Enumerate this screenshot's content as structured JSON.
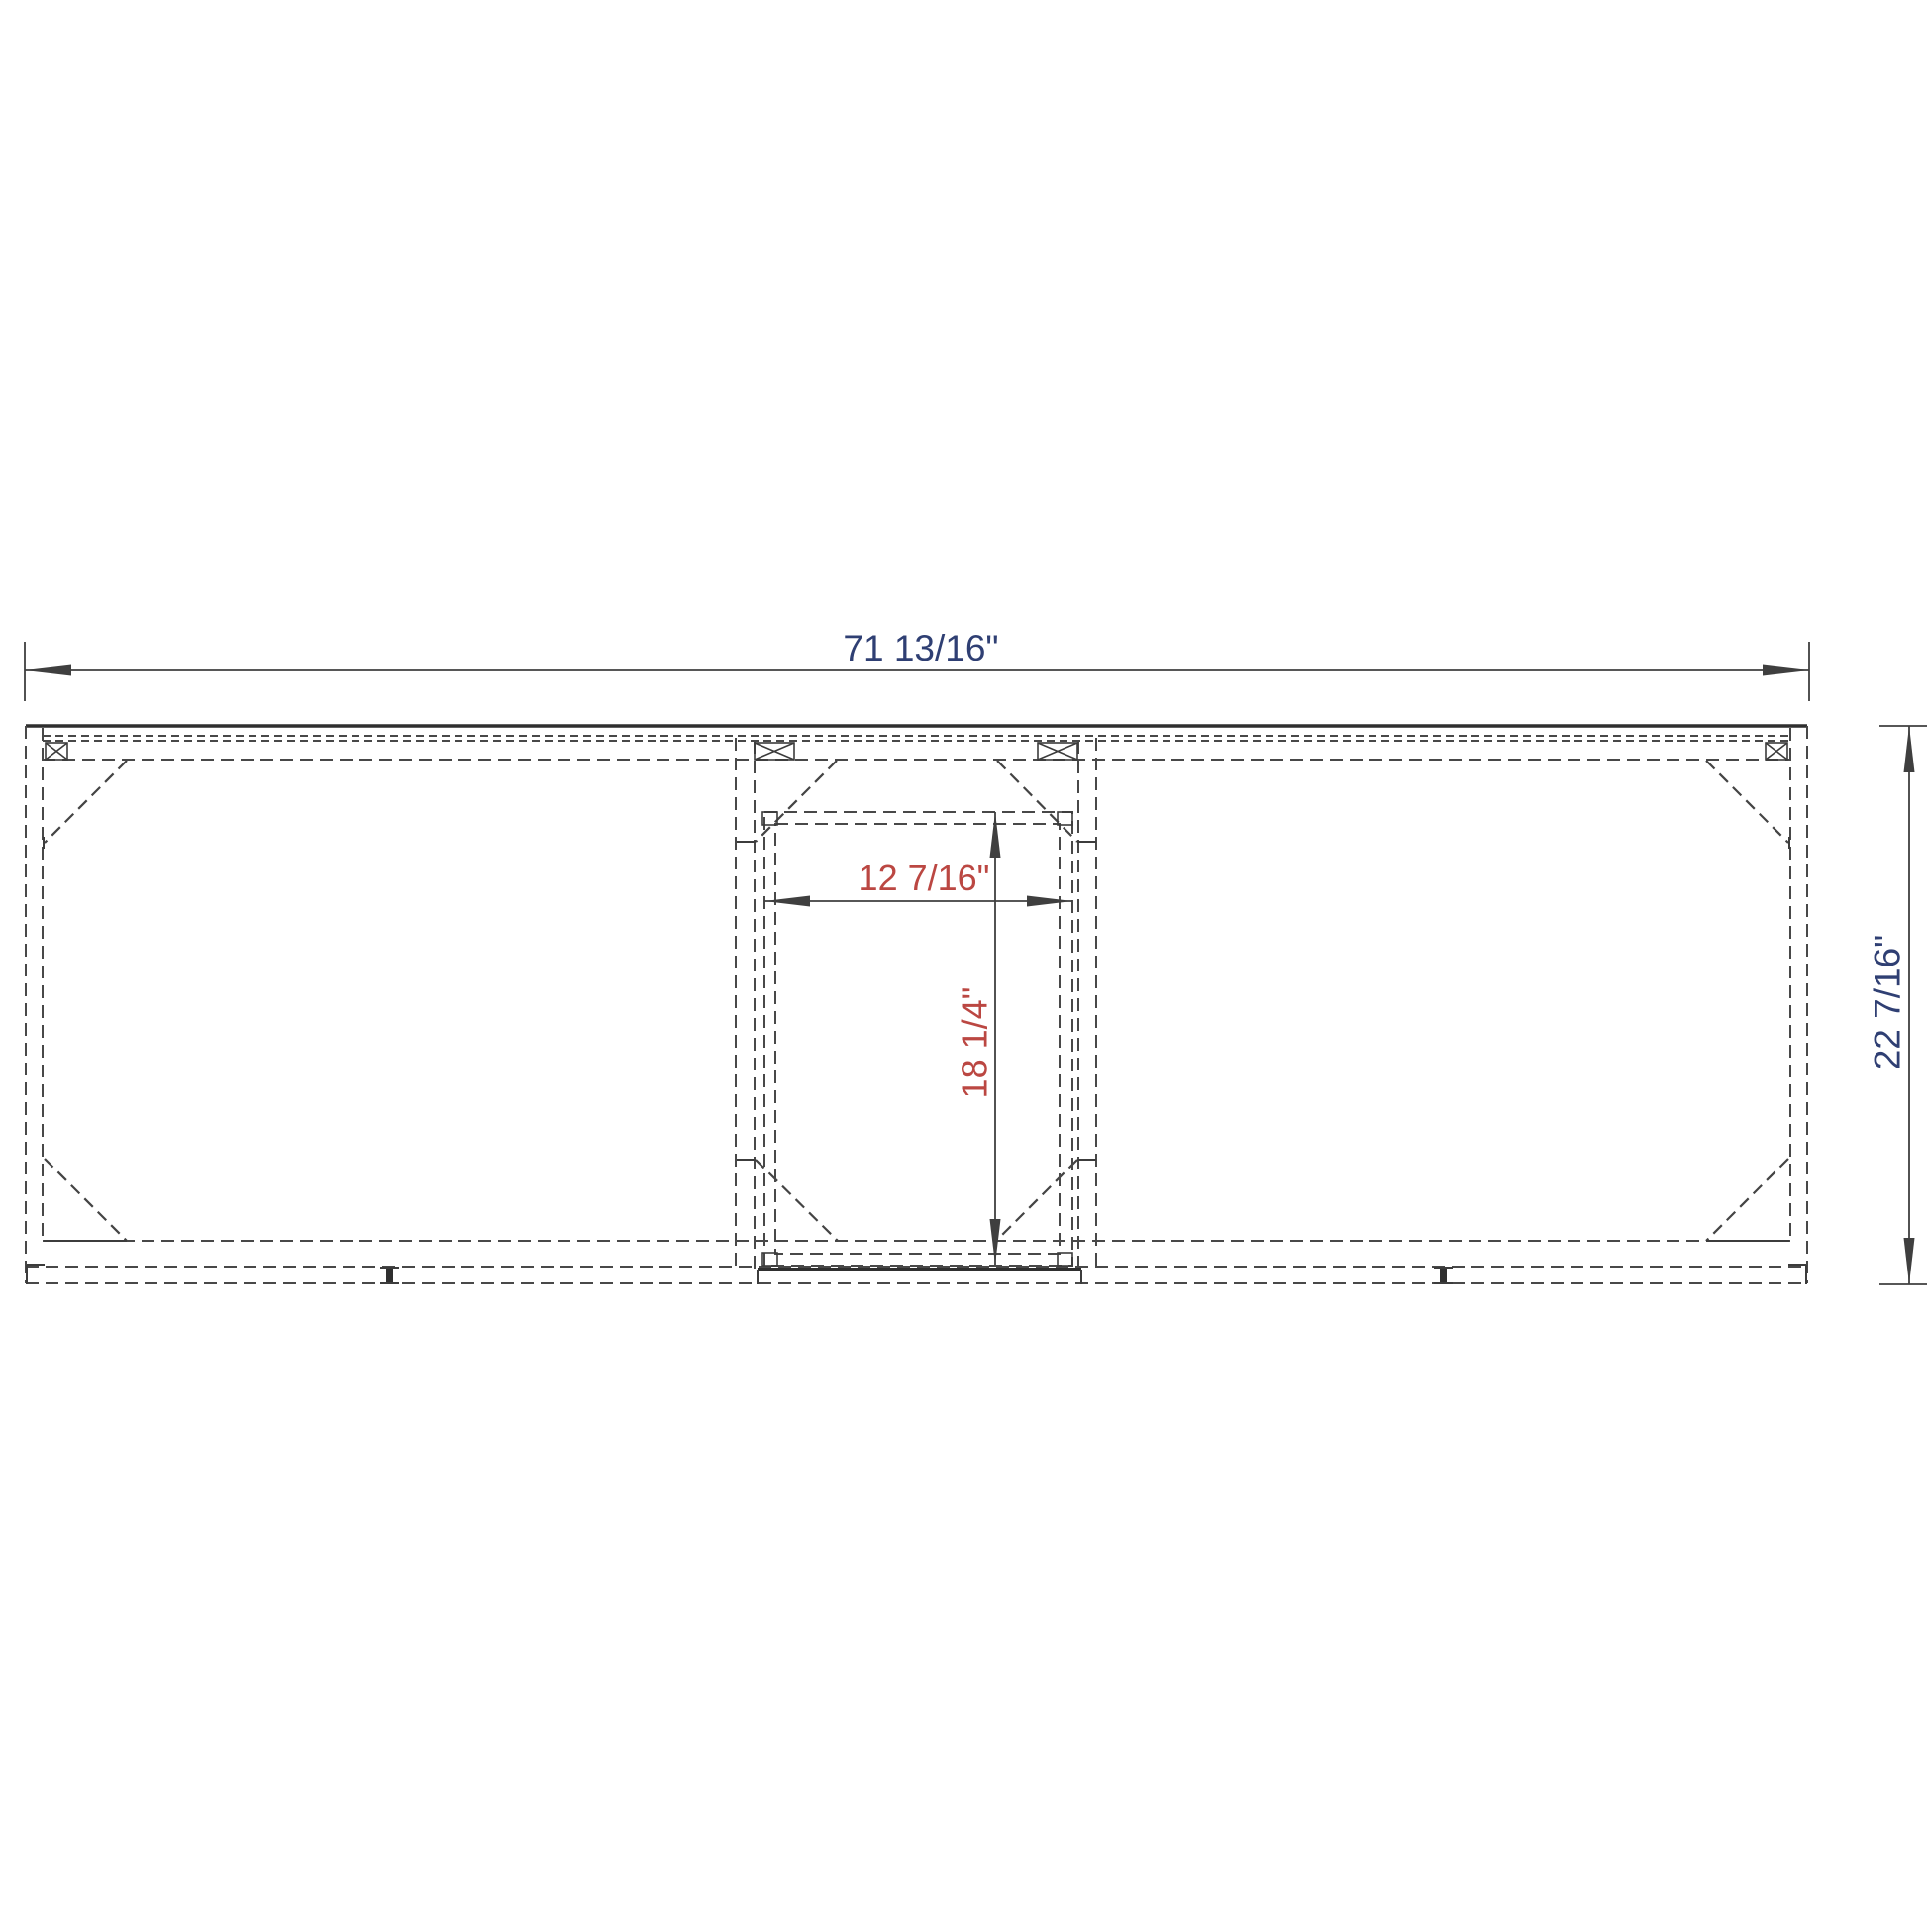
{
  "drawing": {
    "dimensions": {
      "overall_width": "71 13/16\"",
      "overall_depth": "22 7/16\"",
      "opening_width": "12 7/16\"",
      "opening_depth": "18 1/4\""
    },
    "colors": {
      "overall_dimension_text": "#2f3f73",
      "opening_dimension_text": "#bb4742",
      "solid_line": "#3c3c3c",
      "hidden_line": "#484848"
    }
  }
}
